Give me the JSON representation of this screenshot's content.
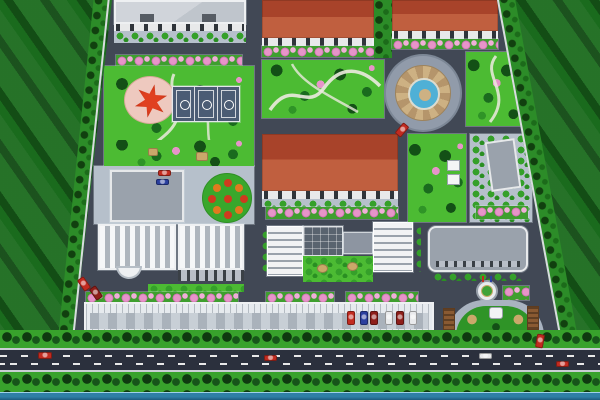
{
  "scene": {
    "type": "aerial-3d-site-plan-rendering",
    "features": [
      "surrounding-farm-fields",
      "perimeter-tree-lines",
      "main-road",
      "riverside-canal",
      "north-office-building",
      "red-roof-workshop-1",
      "red-roof-workshop-2",
      "red-roof-workshop-3",
      "central-garden",
      "circular-fountain-plaza",
      "east-garden",
      "star-plaza-park",
      "basketball-courts",
      "gray-admin-building",
      "circular-flower-bed",
      "ribbed-workshop-a",
      "ribbed-workshop-b",
      "office-complex-with-atrium",
      "east-gray-building",
      "small-east-annex",
      "long-carport",
      "entrance-gate-plaza",
      "small-fountain",
      "pink-blossom-tree-rows"
    ],
    "counts": {
      "basketball_courts": 3,
      "red_roof_workshops": 3,
      "ribbed_workshops": 2,
      "fountains": 2
    }
  },
  "palette": {
    "field_green": "#1a6b1d",
    "road_dark": "#2b303d",
    "campus_road": "#414855",
    "pavement": "#b6c0cb",
    "lawn": "#4cbb33",
    "tree_dark": "#124a15",
    "bush_green": "#35a02a",
    "flower_pink": "#e794c9",
    "roof_red_dark": "#a8432a",
    "roof_red_light": "#c05f3f",
    "roof_gray": "#9aa2ac",
    "glass_dark": "#59636f",
    "court_blue": "#4b5c74",
    "water_blue": "#2f7fa6",
    "fountain_water": "#4fb0d6",
    "plaza_tan": "#cdb183",
    "star_red": "#c83418",
    "star_plaza_pink": "#eec9bf",
    "gate_brown": "#8a5a32",
    "car_red": "#c22b20",
    "car_blue": "#2a3f9e",
    "car_white": "#e9eaec",
    "car_dark_red": "#8e1f1a"
  },
  "cars": [
    {
      "name": "car-main-road-1",
      "color": "car_red",
      "x": 38,
      "y": 352,
      "w": 14,
      "h": 7,
      "rot": 0
    },
    {
      "name": "car-main-road-2",
      "color": "car_red",
      "x": 264,
      "y": 355,
      "w": 13,
      "h": 6,
      "rot": 0
    },
    {
      "name": "car-main-road-3",
      "color": "car_white",
      "x": 479,
      "y": 353,
      "w": 13,
      "h": 6,
      "rot": 0
    },
    {
      "name": "car-main-road-4",
      "color": "car_red",
      "x": 556,
      "y": 361,
      "w": 13,
      "h": 6,
      "rot": 0
    },
    {
      "name": "car-internal-road",
      "color": "car_red",
      "x": 398,
      "y": 123,
      "w": 8,
      "h": 14,
      "rot": 40
    },
    {
      "name": "car-entrance-drive",
      "color": "car_red",
      "x": 536,
      "y": 334,
      "w": 8,
      "h": 14,
      "rot": 10
    },
    {
      "name": "car-parked-1",
      "color": "car_red",
      "x": 80,
      "y": 277,
      "w": 8,
      "h": 14,
      "rot": -35
    },
    {
      "name": "car-parked-2",
      "color": "car_dark_red",
      "x": 92,
      "y": 286,
      "w": 8,
      "h": 14,
      "rot": -35
    },
    {
      "name": "car-lot-red",
      "color": "car_red",
      "x": 158,
      "y": 170,
      "w": 13,
      "h": 6,
      "rot": 0
    },
    {
      "name": "car-lot-blue",
      "color": "car_blue",
      "x": 156,
      "y": 179,
      "w": 13,
      "h": 6,
      "rot": 0
    },
    {
      "name": "carport-car-1",
      "color": "car_red",
      "x": 347,
      "y": 311,
      "w": 8,
      "h": 14,
      "rot": 0
    },
    {
      "name": "carport-car-2",
      "color": "car_blue",
      "x": 360,
      "y": 311,
      "w": 8,
      "h": 14,
      "rot": 0
    },
    {
      "name": "carport-car-3",
      "color": "car_dark_red",
      "x": 370,
      "y": 311,
      "w": 8,
      "h": 14,
      "rot": 0
    },
    {
      "name": "carport-car-4",
      "color": "car_white",
      "x": 385,
      "y": 311,
      "w": 8,
      "h": 14,
      "rot": 0
    },
    {
      "name": "carport-car-5",
      "color": "car_dark_red",
      "x": 396,
      "y": 311,
      "w": 8,
      "h": 14,
      "rot": 0
    },
    {
      "name": "carport-car-6",
      "color": "car_white",
      "x": 409,
      "y": 311,
      "w": 8,
      "h": 14,
      "rot": 0
    }
  ]
}
